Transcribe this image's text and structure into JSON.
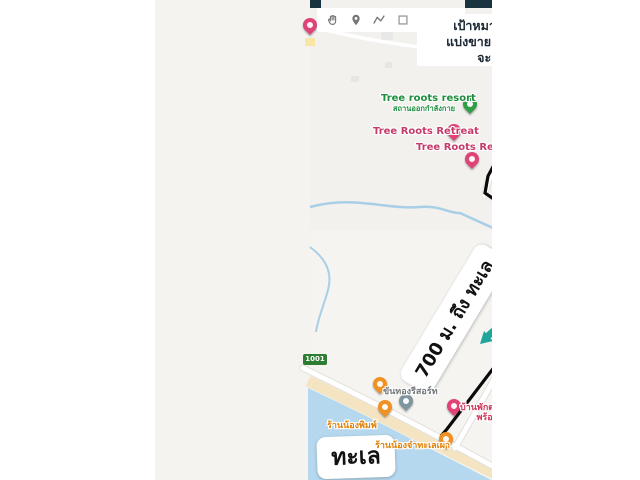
{
  "colors": {
    "top_bar": "#18333f",
    "route": "#0a0a0a",
    "teal_arrow": "#1fa59b",
    "sea": "#b5d8ee",
    "beach": "#f4e4c2",
    "river": "#a9cfe6",
    "pin_pink": "#df4377",
    "pin_orange": "#f09122",
    "pin_green": "#2f9e44",
    "pin_grey": "#8195a0",
    "target_pin_green": "#7cb342"
  },
  "toolbar": {
    "icons": [
      "pan-hand",
      "add-marker",
      "draw-line",
      "shape-square",
      "shape-circle",
      "bird-shape"
    ]
  },
  "annotation": {
    "line1": "เป้าหมาย   10-3-35 ไร่",
    "line2": "แบ่งขายครับแล้วแต่คนซื้อ",
    "line3": "จะต้องการกี่ไร่"
  },
  "callouts": {
    "distance": "700 ม. ถึง ทะเล",
    "sea": "ทะเล"
  },
  "roads": {
    "noen_saem": "เนินแซม",
    "noen_saem_vertical": "เนินแซม",
    "chokdee": "โชคดี",
    "soi": "ซอยทะเล",
    "shield": "1001"
  },
  "pois": {
    "tree_roots_resort": {
      "label": "Tree roots resort",
      "sub": "สถานออกกำลังกาย"
    },
    "tree_roots_retreat_1": {
      "label": "Tree Roots Retreat"
    },
    "tree_roots_retreat_2": {
      "label": "Tree Roots Retreat"
    },
    "baan_bettina": {
      "label": "Baan Bettina"
    },
    "luxury": {
      "label": "Luxury"
    },
    "anita_o_kenth": {
      "label": "Anita o Kenth"
    },
    "maerampueng_beach_house": {
      "line1": "แม่รำพึงบีชเฮ้า",
      "line2": "บ้านพักติดทะเล"
    },
    "welli_hotel": {
      "line1": "โรงแรมเวลลิ",
      "line2": "หาดแม่รำพึง"
    },
    "banphak_maerampueng2": {
      "line1": "บ้านพักแม่รำพึง",
      "line2": "บีชเฮ้า2"
    },
    "great_rayong": {
      "label": "The Great Rayong"
    },
    "chonnikan": {
      "label": "บ้านพักชนนิกานต์"
    },
    "rainbow_rental": {
      "line1": "Rainbow Rental - ร้าน",
      "line2": "เช่ามอเตอร์ไซค์..."
    },
    "khanthong_resort": {
      "label": "ขันทองรีสอร์ท"
    },
    "takakard_phromphong": {
      "line1": "บ้านพักตากอากาศ",
      "line2": "พร้อมพงษ์"
    },
    "nong_pim": {
      "label": "ร้านน้องพิมพ์"
    },
    "nong_ja": {
      "label": "ร้านน้องจ๋าทะเลเผา"
    },
    "hotel_clipped": {
      "label": "โรงแรมรวงทองบีช"
    }
  }
}
